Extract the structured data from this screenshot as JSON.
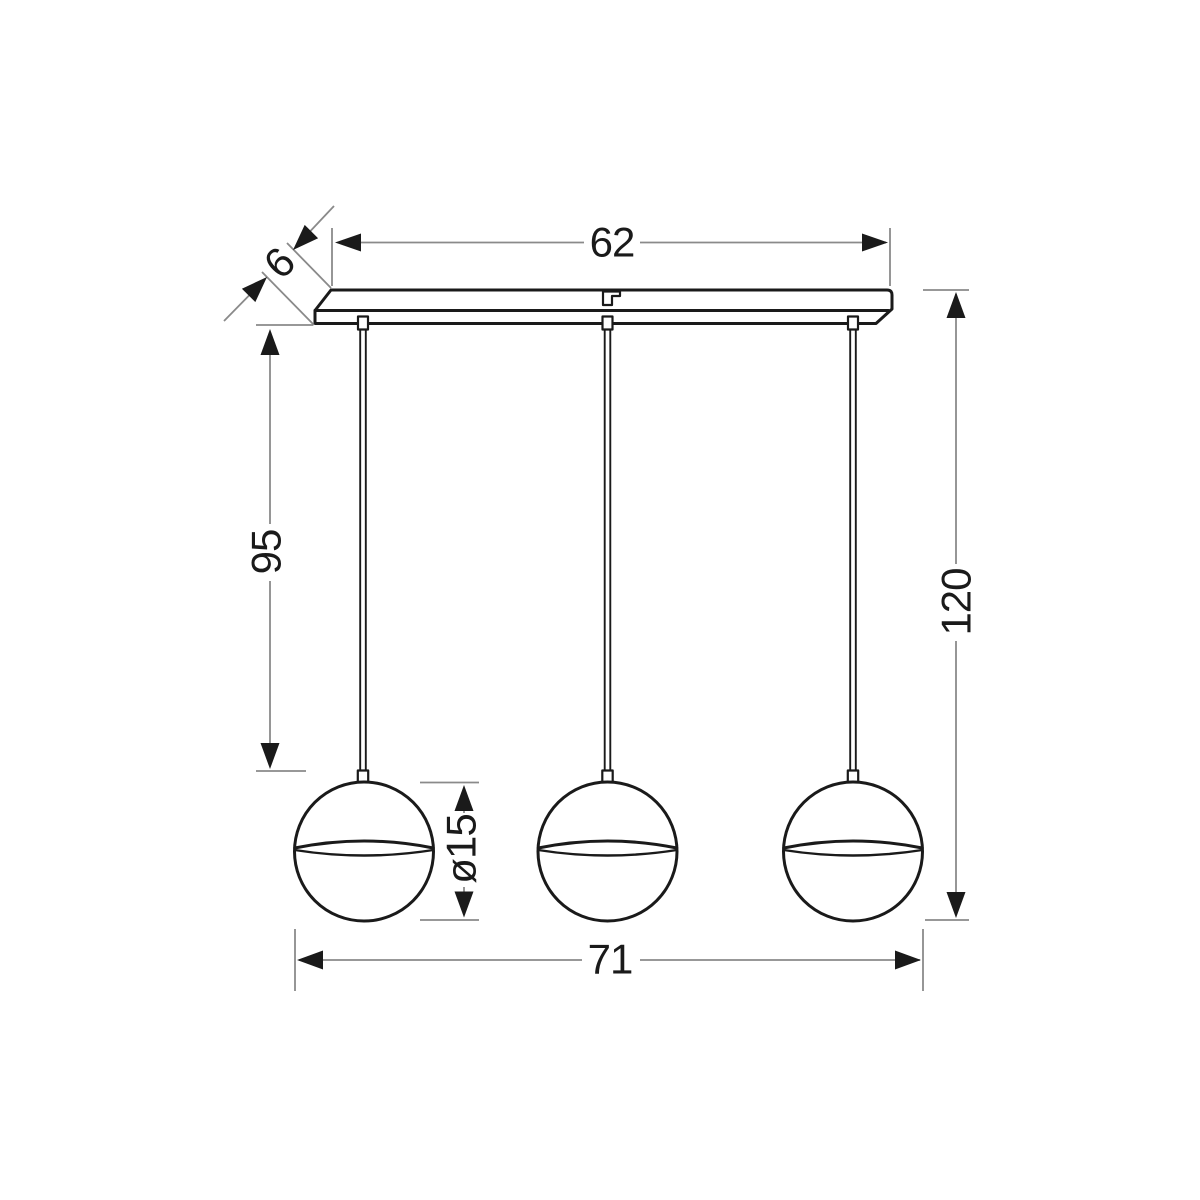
{
  "drawing": {
    "pendant_count": 3,
    "labels": {
      "bar_length": "62",
      "bar_depth": "6",
      "suspension_drop": "95",
      "overall_height": "120",
      "shade_diameter": "ø15",
      "overall_width": "71"
    },
    "colors": {
      "outline": "#1a1a1a",
      "dimension_line": "#8a8a8a",
      "background": "#ffffff"
    }
  }
}
